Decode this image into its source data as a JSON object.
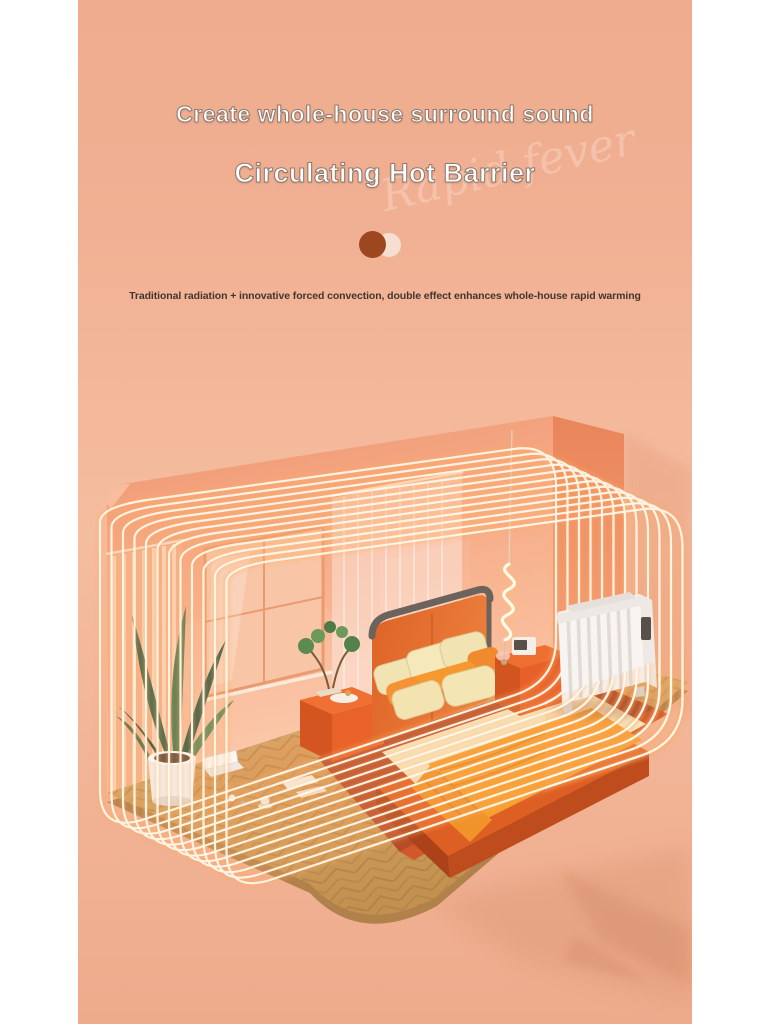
{
  "page": {
    "background": "#ffffff",
    "panel_background": "#f0ae90"
  },
  "header": {
    "title": "Create whole-house surround sound",
    "subtitle": "Circulating Hot Barrier",
    "watermark": "Rapid fever",
    "description": "Traditional radiation + innovative forced convection, double effect enhances whole-house rapid warming"
  },
  "pagination": {
    "active_color": "#9d4721",
    "inactive_color": "#f6dfd0"
  },
  "scene": {
    "label": "isometric bedroom 3D render with electric radiator heater and circulating heat barrier lines",
    "items": [
      "back-wall",
      "side-wall-return",
      "window",
      "orange-curtain",
      "sheer-curtain",
      "wood-parquet-floor",
      "area-rug",
      "bed-with-headboard",
      "cream-pillows",
      "orange-blanket",
      "left-nightstand",
      "bonsai-plant",
      "right-nightstand",
      "bedside-device",
      "floor-plant-in-white-pot",
      "spiral-pendant-light",
      "electric-radiator-heater",
      "laptop-on-floor",
      "papers-on-floor",
      "coffee-cup",
      "heat-circulation-glow-lines",
      "cast-shadow"
    ],
    "palette": {
      "wall": "#f2a17e",
      "wall_light": "#f9c3a2",
      "wall_dark_band": "#ec8a5e",
      "floor_wood": "#d4a266",
      "rug": "#b64c2a",
      "bed_orange": "#e2672b",
      "blanket_orange": "#f59d33",
      "pillow_cream": "#f4e6b8",
      "heater_white": "#f7f4f1",
      "plant_green": "#55754e",
      "glow_core": "#fff8e9",
      "glow_halo": "#ffab63"
    }
  }
}
